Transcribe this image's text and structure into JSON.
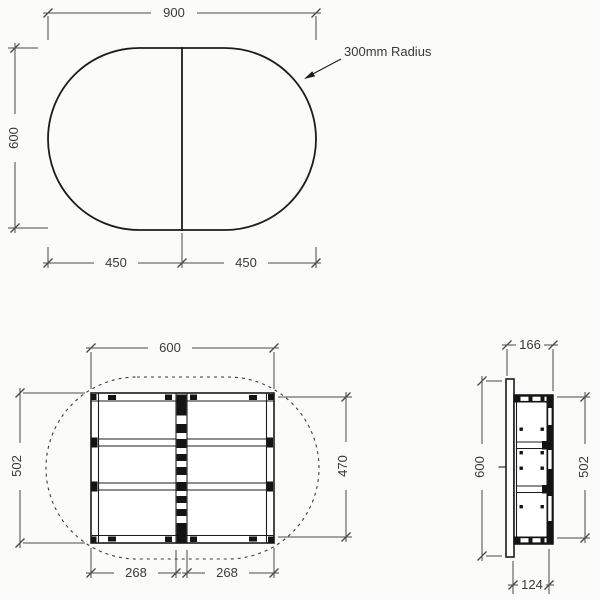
{
  "colors": {
    "background": "#fbfbf9",
    "object_line": "#1c1c1c",
    "dimension_line": "#4a4a4a",
    "text": "#3a3a3a"
  },
  "top_view": {
    "width": "900",
    "height": "600",
    "left_half": "450",
    "right_half": "450",
    "radius_note": "300mm Radius"
  },
  "frame_plan": {
    "width": "600",
    "height": "502",
    "inner_height": "470",
    "left_bay": "268",
    "right_bay": "268"
  },
  "side_view": {
    "depth": "166",
    "height": "600",
    "frame_height": "502",
    "frame_depth": "124"
  }
}
